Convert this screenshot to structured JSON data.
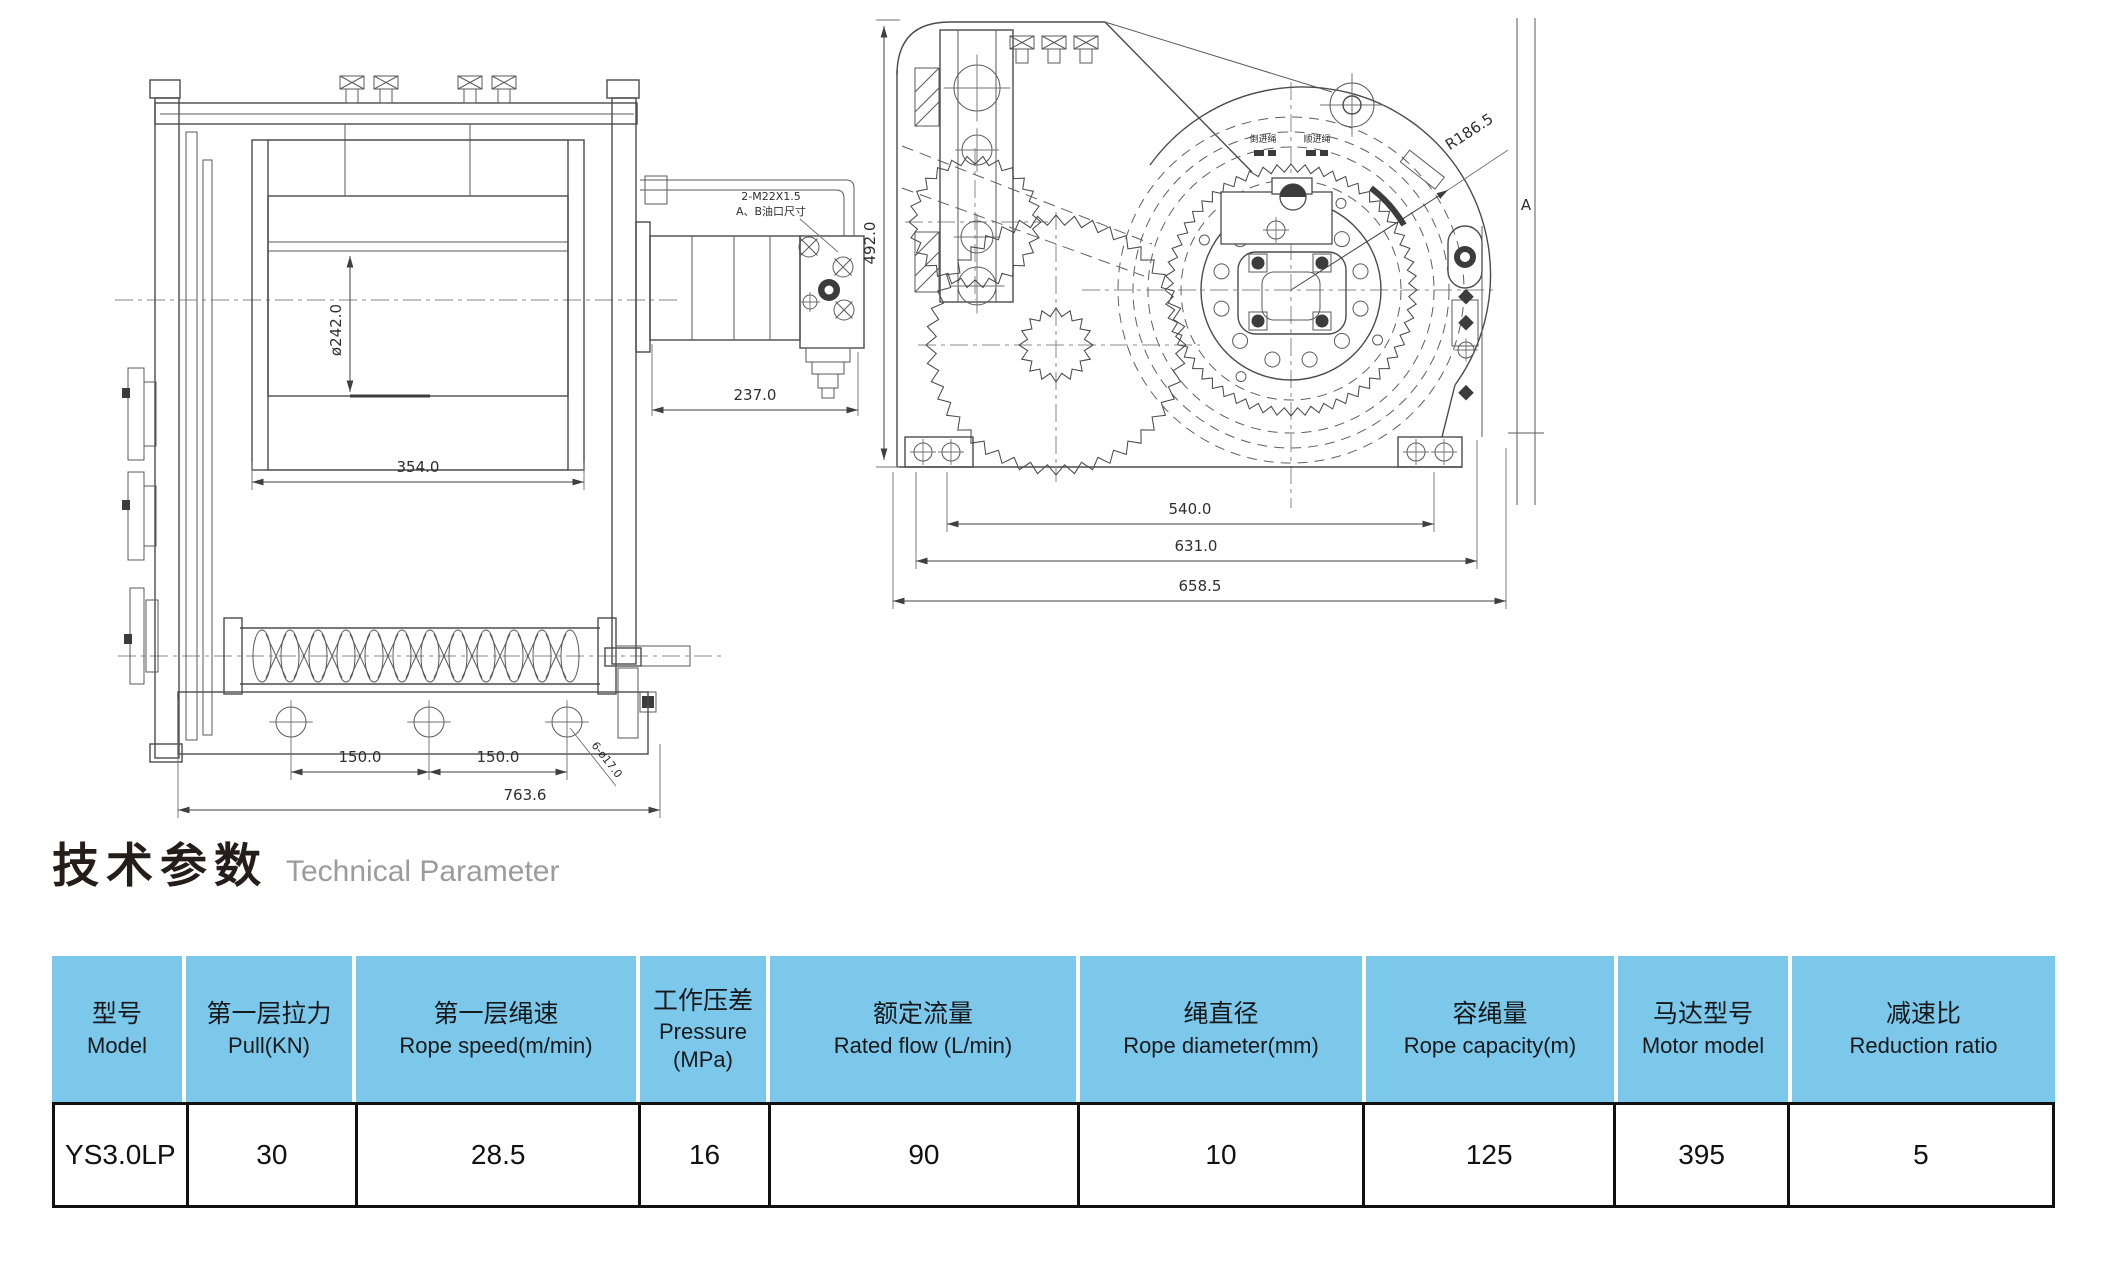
{
  "title": {
    "zh": "技术参数",
    "en": "Technical Parameter"
  },
  "colors": {
    "header_bg": "#7cc8eb",
    "table_border": "#111111",
    "drawing_line": "#4b4b4b"
  },
  "drawing": {
    "left_view": {
      "drum_diameter": "ø242.0",
      "drum_length": "354.0",
      "motor_length": "237.0",
      "port_note_line1": "2-M22X1.5",
      "port_note_line2": "A、B油口尺寸",
      "hole_spacing_1": "150.0",
      "hole_spacing_2": "150.0",
      "base_width": "763.6",
      "hole_note": "6-ø17.0"
    },
    "right_view": {
      "overall_height": "492.0",
      "flange_radius": "R186.5",
      "section_label": "A",
      "bolt_span": "540.0",
      "base_span": "631.0",
      "overall_width": "658.5",
      "rope_in_label_left": "倒进绳",
      "rope_in_label_right": "顺进绳"
    }
  },
  "table": {
    "headers": [
      {
        "zh": "型号",
        "en": "Model"
      },
      {
        "zh": "第一层拉力",
        "en": "Pull(KN)"
      },
      {
        "zh": "第一层绳速",
        "en": "Rope speed(m/min)"
      },
      {
        "zh": "工作压差",
        "en": "Pressure (MPa)"
      },
      {
        "zh": "额定流量",
        "en": "Rated flow (L/min)"
      },
      {
        "zh": "绳直径",
        "en": "Rope diameter(mm)"
      },
      {
        "zh": "容绳量",
        "en": "Rope capacity(m)"
      },
      {
        "zh": "马达型号",
        "en": "Motor model"
      },
      {
        "zh": "减速比",
        "en": "Reduction ratio"
      }
    ],
    "row": [
      "YS3.0LP",
      "30",
      "28.5",
      "16",
      "90",
      "10",
      "125",
      "395",
      "5"
    ]
  }
}
